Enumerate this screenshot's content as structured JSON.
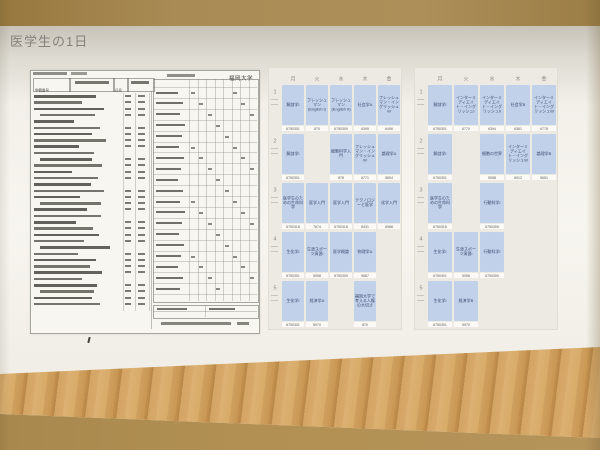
{
  "slide": {
    "title": "医学生の1日"
  },
  "transcript": {
    "university": "福岡大学",
    "student_id_label": "学籍番号",
    "name_label": "氏名"
  },
  "timetables": [
    {
      "days": [
        "月",
        "火",
        "水",
        "木",
        "金"
      ],
      "periods": [
        "1",
        "2",
        "3",
        "4",
        "5"
      ],
      "rows": [
        [
          {
            "t": "解剖学I",
            "c": "6750301"
          },
          {
            "t": "フレッシュマン (English I)",
            "c": "870"
          },
          {
            "t": "フレッシュマン (English II)",
            "c": "6750309"
          },
          {
            "t": "社会学A",
            "c": "6395"
          },
          {
            "t": "フレッシュマン・イングリッシュW",
            "c": "6496"
          }
        ],
        [
          {
            "t": "解剖学I",
            "c": "6750301"
          },
          null,
          {
            "t": "細胞科学入門",
            "c": "878"
          },
          {
            "t": "フレッシュマン・イングリッシュW",
            "c": "6771"
          },
          {
            "t": "論理学A",
            "c": "5654"
          }
        ],
        [
          {
            "t": "医学生のための生命科学",
            "c": "6750318"
          },
          {
            "t": "医学入門",
            "c": "7674"
          },
          {
            "t": "医学入門",
            "c": "6750318"
          },
          {
            "t": "テクノロジーと医学",
            "c": "8431"
          },
          {
            "t": "化学入門",
            "c": "6988"
          }
        ],
        [
          {
            "t": "生化学I",
            "c": "6750301"
          },
          {
            "t": "生涯スポーツ演習I",
            "c": "5058"
          },
          {
            "t": "医学概論",
            "c": "6750309"
          },
          {
            "t": "物理学A",
            "c": "5687"
          },
          null
        ],
        [
          {
            "t": "生化学I",
            "c": "6750301"
          },
          {
            "t": "経済学A",
            "c": "5970"
          },
          null,
          {
            "t": "福岡大学で考える人権の大切さ",
            "c": "870"
          },
          null
        ]
      ]
    },
    {
      "days": [
        "月",
        "火",
        "水",
        "木",
        "金"
      ],
      "periods": [
        "1",
        "2",
        "3",
        "4",
        "5"
      ],
      "rows": [
        [
          {
            "t": "解剖学I",
            "c": "6750301"
          },
          {
            "t": "インターミディエイト・イングリッシュI",
            "c": "6770"
          },
          {
            "t": "インターミディエイト・イングリッシュII",
            "c": "6394"
          },
          {
            "t": "社会学B",
            "c": "6381"
          },
          {
            "t": "インターミディエイト・イングリッシュW",
            "c": "6778"
          }
        ],
        [
          {
            "t": "解剖学I",
            "c": "6750301"
          },
          null,
          {
            "t": "細胞の世界",
            "c": "5058"
          },
          {
            "t": "インターミディエイト・イングリッシュW",
            "c": "6912"
          },
          {
            "t": "論理学B",
            "c": "5651"
          }
        ],
        [
          {
            "t": "医学生のための生命科学",
            "c": "6750318"
          },
          null,
          {
            "t": "行動科学I",
            "c": "6750309"
          },
          null,
          null
        ],
        [
          {
            "t": "生化学I",
            "c": "6750301"
          },
          {
            "t": "生涯スポーツ演習I",
            "c": "5058"
          },
          {
            "t": "行動科学I",
            "c": "6750309"
          },
          null,
          null
        ],
        [
          {
            "t": "生化学I",
            "c": "6750301"
          },
          {
            "t": "経済学B",
            "c": "5970"
          },
          null,
          null,
          null
        ]
      ]
    }
  ]
}
